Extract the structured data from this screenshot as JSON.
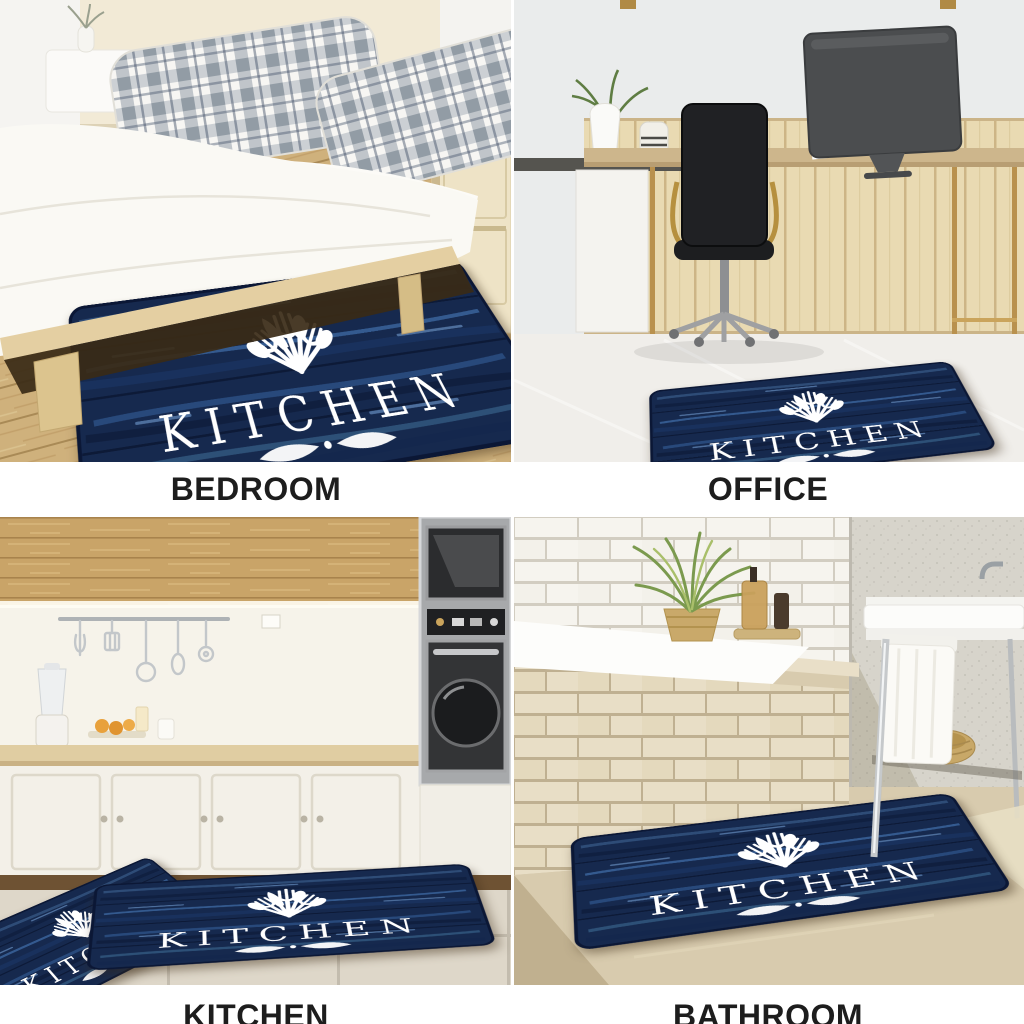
{
  "product": {
    "mat": {
      "text": "KITCHEN",
      "print_color": "#ffffff",
      "base_color": "#16294e",
      "streak_color": "#4f83c4",
      "icons": [
        "cutlery-fan-icon",
        "flourish-icon"
      ]
    }
  },
  "collage": {
    "background": "#ffffff",
    "label_color": "#1d1d1d",
    "cells": [
      {
        "id": "bedroom",
        "label": "BEDROOM"
      },
      {
        "id": "office",
        "label": "OFFICE"
      },
      {
        "id": "kitchen",
        "label": "KITCHEN"
      },
      {
        "id": "bathroom",
        "label": "BATHROOM"
      }
    ]
  }
}
